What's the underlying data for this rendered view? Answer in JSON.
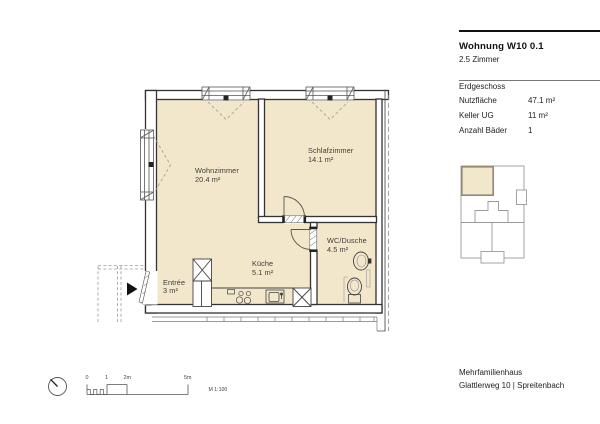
{
  "panel": {
    "title": "Wohnung W10 0.1",
    "subtitle": "2.5 Zimmer",
    "floor_label": "Erdgeschoss",
    "rows": [
      {
        "label": "Nutzfläche",
        "value": "47.1 m²"
      },
      {
        "label": "Keller UG",
        "value": "11 m²"
      },
      {
        "label": "Anzahl Bäder",
        "value": "1"
      }
    ],
    "footer_line1": "Mehrfamilienhaus",
    "footer_line2": "Glattlerweg 10 | Spreitenbach"
  },
  "plan": {
    "rooms": [
      {
        "name": "Wohnzimmer",
        "area": "20.4 m²"
      },
      {
        "name": "Schlafzimmer",
        "area": "14.1 m²"
      },
      {
        "name": "Küche",
        "area": "5.1 m²"
      },
      {
        "name": "Entrée",
        "area": "3 m²"
      },
      {
        "name": "WC/Dusche",
        "area": "4.5 m²"
      }
    ]
  },
  "scalebar": {
    "labels": [
      "0",
      "1",
      "2m",
      "5m"
    ],
    "scale_label": "M 1:100"
  },
  "colors": {
    "room_fill": "#f3e7cb",
    "wall": "#333333",
    "site_highlight_border": "#94896f"
  }
}
